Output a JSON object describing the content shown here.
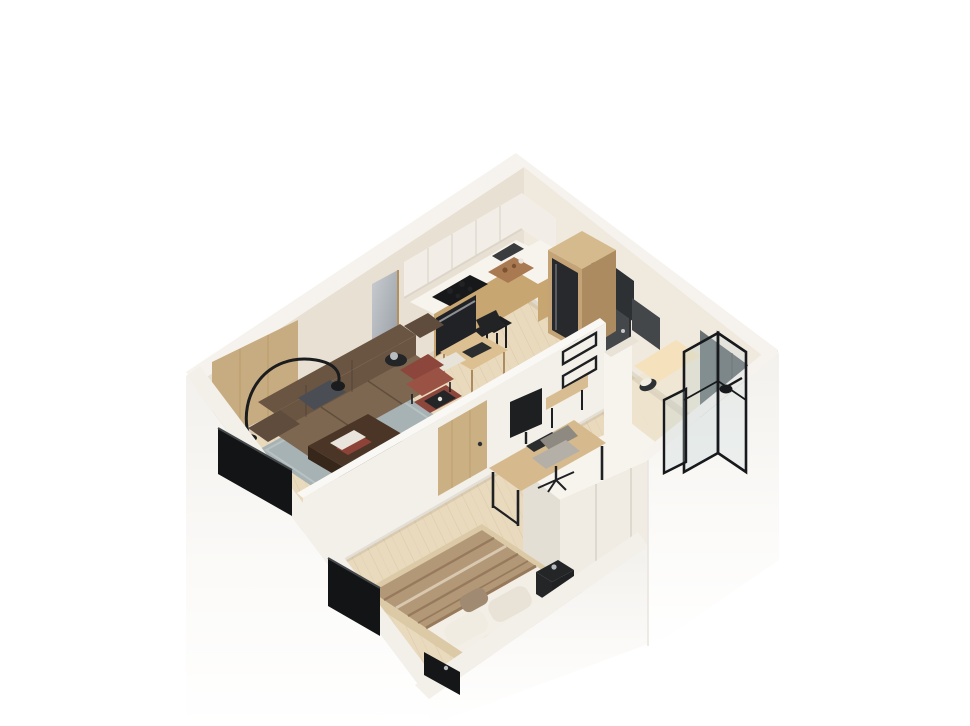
{
  "meta": {
    "description": "3D isometric cutaway render of a small studio apartment floor plan on a white background",
    "style": "photoreal axonometric dollhouse view",
    "page_bg": "#ffffff"
  },
  "colors": {
    "page_bg": "#ffffff",
    "wall_top": "#f6f3ee",
    "wall_exterior": "#fbfaf8",
    "wall_exterior_low": "#f3f1ed",
    "wall_exterior_edge": "#e9e6e0",
    "wall_nw_inner": "#e8e0d3",
    "wall_ne_inner": "#f0e9de",
    "wall_divider": "#f3f0e9",
    "wall_divider_top": "#faf8f4",
    "wall_pillar": "#f7f4ee",
    "wall_pillar_side": "#e8e2d7",
    "band_top": "#f3f0ea",
    "floor_wood": "#e9dabe",
    "floor_wood_warm": "#e4d2b2",
    "floor_plank": "#c9b28e",
    "floor_bath": "#efe5d1",
    "vanity_glow": "#f5e2bd",
    "mat_gray": "#d8d5cf",
    "ao": "rgba(90,75,55,0.10)",
    "rug": "#a7b2b5",
    "rug_light": "#bdc6c7",
    "sofa_back": "#6a5543",
    "sofa_seat": "#7d6751",
    "sofa_arm": "#5f4c3c",
    "sofa_seam": "#4e3d2f",
    "pillow_dark": "#4a4d53",
    "wood_panel": "#c8ac81",
    "wood_grain": "#b2905f",
    "table_dark": "#4a3526",
    "table_dark_side": "#37271a",
    "book_white": "#e9e5dd",
    "book_red": "#8e4338",
    "chair_red": "#8c463c",
    "chair_red_light": "#9a5244",
    "tray_black": "#232527",
    "lamp_black": "#1b1c1e",
    "tv_black": "#131416",
    "cab_white": "#f2eee7",
    "cab_seam": "#dcd6ca",
    "counter_white": "#f7f4ed",
    "counter_wood": "#c8a671",
    "stove_black": "#17181a",
    "oven_black": "#212225",
    "steel": "#8e9194",
    "sink_dark": "#3a3c3e",
    "board_wood": "#a97a52",
    "board_dark": "#7d5233",
    "fridge_wood_top": "#d4ba8d",
    "fridge_wood": "#c4a376",
    "fridge_wood_dark": "#ad8b60",
    "fridge_black": "#27292c",
    "stool_black": "#1c1d1f",
    "table_oak": "#dcc091",
    "chair_black": "#212325",
    "chair_light": "#e8e3d8",
    "radio_dark": "#2b2d2f",
    "mirror_a": "#c9cdd2",
    "mirror_b": "#93999f",
    "door_dark": "#45484b",
    "door_dark_edge": "#2e3134",
    "handle_silver": "#c6c8ca",
    "door_oak": "#cbb084",
    "rack_black": "#1d1f21",
    "bench_wood": "#d9bd92",
    "tile_dark": "#6b7274",
    "tile_dark2": "#5c6365",
    "glass_tint": "#bed2d5",
    "frame_black": "#17191c",
    "mirror_dark": "#43474a",
    "toilet_dark": "#2e3133",
    "wardrobe_front": "#f0ece4",
    "wardrobe_top": "#f7f4ee",
    "wardrobe_side": "#e4dfd4",
    "wardrobe_seam": "#d8d3c8",
    "desk_oak": "#d6ba8e",
    "desk_leg": "#1f2123",
    "monitor_black": "#1d1f21",
    "key_dark": "#2a2c2e",
    "ochair_gray": "#b4b0a8",
    "ochair_dark": "#8e8a82",
    "bed_platform": "#dccaa6",
    "bed_platform_side": "#c6af88",
    "mattress": "#f3efe7",
    "blanket": "#b29877",
    "blanket_stripe": "#97795c",
    "blanket_cream": "#d9c8b0",
    "pillow_white": "#f1ece2",
    "pillow_white2": "#e9e3d7",
    "pillow_tan": "#a08b72",
    "nightstand_black": "#232527",
    "silver_item": "#b9bcbe",
    "speaker_black": "#151617"
  },
  "inventory": {
    "rooms": [
      {
        "name": "kitchen",
        "items": [
          "white upper cabinets",
          "L-shaped counter with gas hob and oven",
          "corner sink",
          "cutting board with food",
          "tall wood column with built-in fridge",
          "black bar stool",
          "small oak table with two chairs"
        ]
      },
      {
        "name": "living-room",
        "items": [
          "three-seat brown leather sofa",
          "dark gray throw pillow",
          "black arc floor lamp",
          "blue-gray area rug",
          "dark walnut coffee table with books",
          "burgundy lounge chair with ottoman and black tray",
          "black round side table",
          "leaning silver mirror",
          "oak wall panel",
          "wall-mounted TV on cutaway wall"
        ]
      },
      {
        "name": "bedroom",
        "items": [
          "platform double bed",
          "striped tan blanket",
          "white and tan pillows",
          "black nightstand with lamp",
          "oak desk with monitor, keyboard and mouse",
          "gray office chair",
          "white wardrobe",
          "wall-mounted TV on cutaway wall",
          "black media box"
        ]
      },
      {
        "name": "hallway",
        "items": [
          "charcoal entry door",
          "gray door mat",
          "black wall racks",
          "floating wood bench"
        ]
      },
      {
        "name": "bathroom",
        "items": [
          "walk-in shower with black-framed glass",
          "dark slate feature wall",
          "black shower head",
          "dark wall mirror",
          "lit vanity niche",
          "toilet"
        ]
      }
    ]
  }
}
